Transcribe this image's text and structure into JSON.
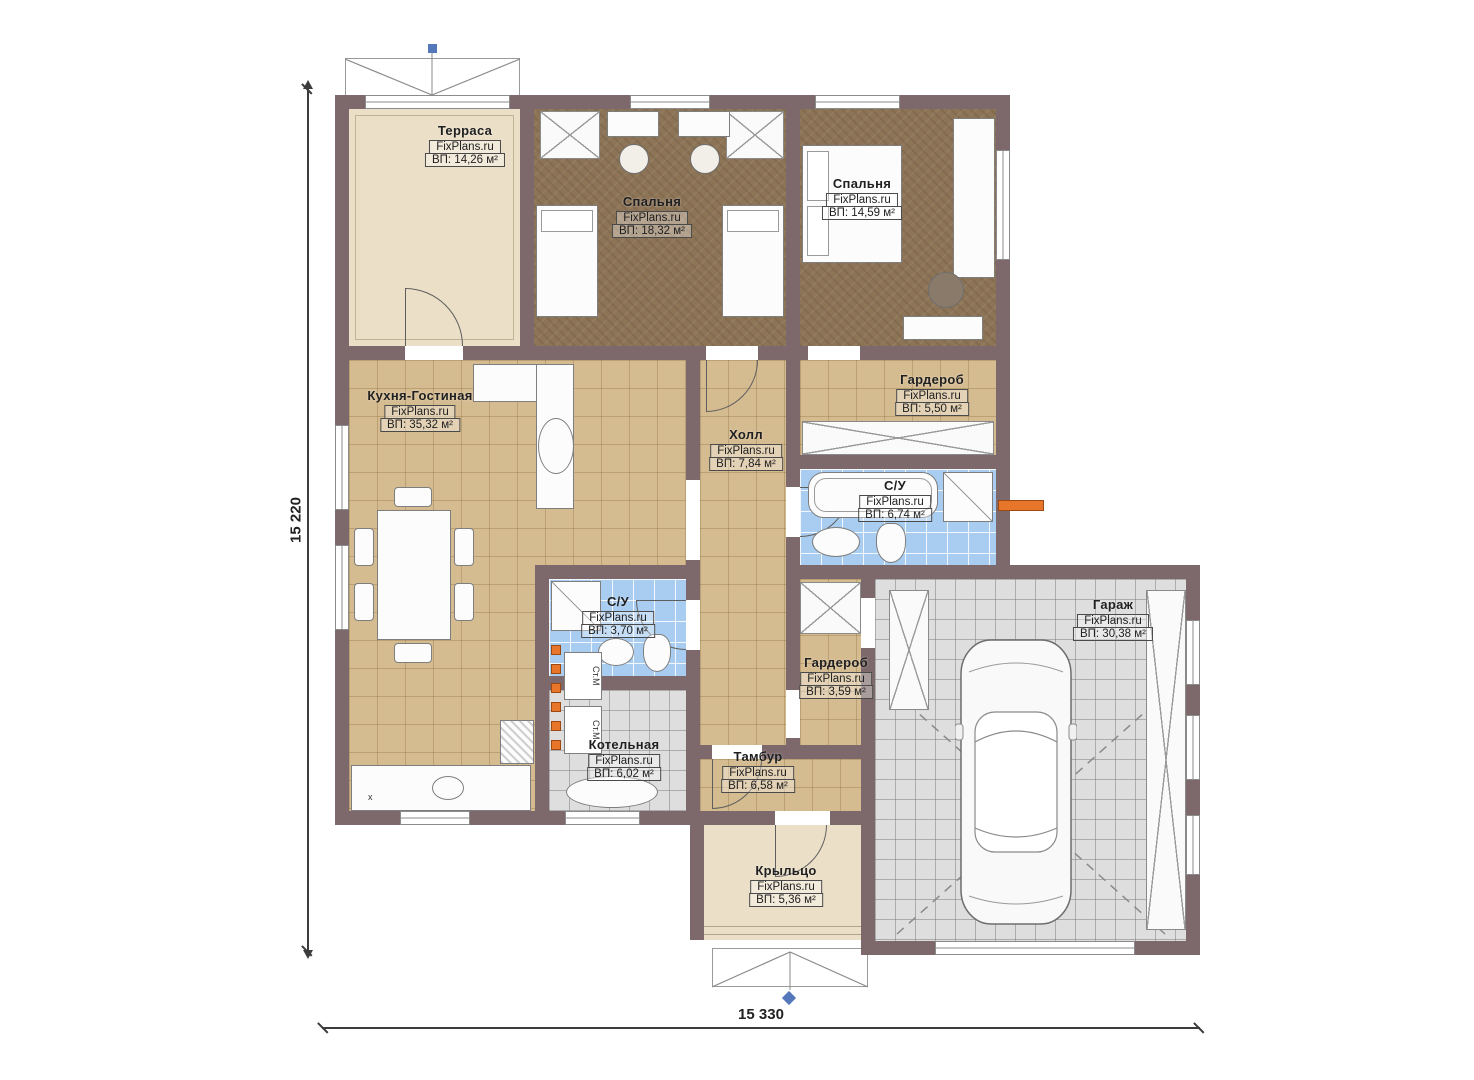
{
  "plan_title": "floor-plan",
  "dimensions": {
    "height_label": "15 220",
    "width_label": "15 330"
  },
  "rooms": [
    {
      "id": "terrace",
      "name": "Терраса",
      "brand": "FixPlans.ru",
      "area": "ВП: 14,26 м²"
    },
    {
      "id": "bedroom1",
      "name": "Спальня",
      "brand": "FixPlans.ru",
      "area": "ВП: 18,32 м²"
    },
    {
      "id": "bedroom2",
      "name": "Спальня",
      "brand": "FixPlans.ru",
      "area": "ВП: 14,59 м²"
    },
    {
      "id": "kitchen",
      "name": "Кухня-Гостиная",
      "brand": "FixPlans.ru",
      "area": "ВП: 35,32 м²"
    },
    {
      "id": "hall",
      "name": "Холл",
      "brand": "FixPlans.ru",
      "area": "ВП: 7,84 м²"
    },
    {
      "id": "wardrobe1",
      "name": "Гардероб",
      "brand": "FixPlans.ru",
      "area": "ВП: 5,50 м²"
    },
    {
      "id": "bath1",
      "name": "С/У",
      "brand": "FixPlans.ru",
      "area": "ВП: 6,74 м²"
    },
    {
      "id": "bath2",
      "name": "С/У",
      "brand": "FixPlans.ru",
      "area": "ВП: 3,70 м²"
    },
    {
      "id": "wardrobe2",
      "name": "Гардероб",
      "brand": "FixPlans.ru",
      "area": "ВП: 3,59 м²"
    },
    {
      "id": "boiler",
      "name": "Котельная",
      "brand": "FixPlans.ru",
      "area": "ВП: 6,02 м²"
    },
    {
      "id": "vestibule",
      "name": "Тамбур",
      "brand": "FixPlans.ru",
      "area": "ВП: 6,58 м²"
    },
    {
      "id": "garage",
      "name": "Гараж",
      "brand": "FixPlans.ru",
      "area": "ВП: 30,38 м²"
    },
    {
      "id": "porch",
      "name": "Крыльцо",
      "brand": "FixPlans.ru",
      "area": "ВП: 5,36 м²"
    }
  ],
  "appliances": {
    "washer1": "Ст.М",
    "washer2": "Ст.М",
    "stove_mark": "x"
  },
  "colors": {
    "wall": "#7d696b",
    "tile_tan": "#d5bb90",
    "tile_blue": "#a9cdf0",
    "tile_grey": "#dedede",
    "floor_brown": "#8d7456",
    "floor_beige": "#ebdfc8",
    "radiator_orange": "#e8762a",
    "marker_blue": "#5577bb"
  }
}
